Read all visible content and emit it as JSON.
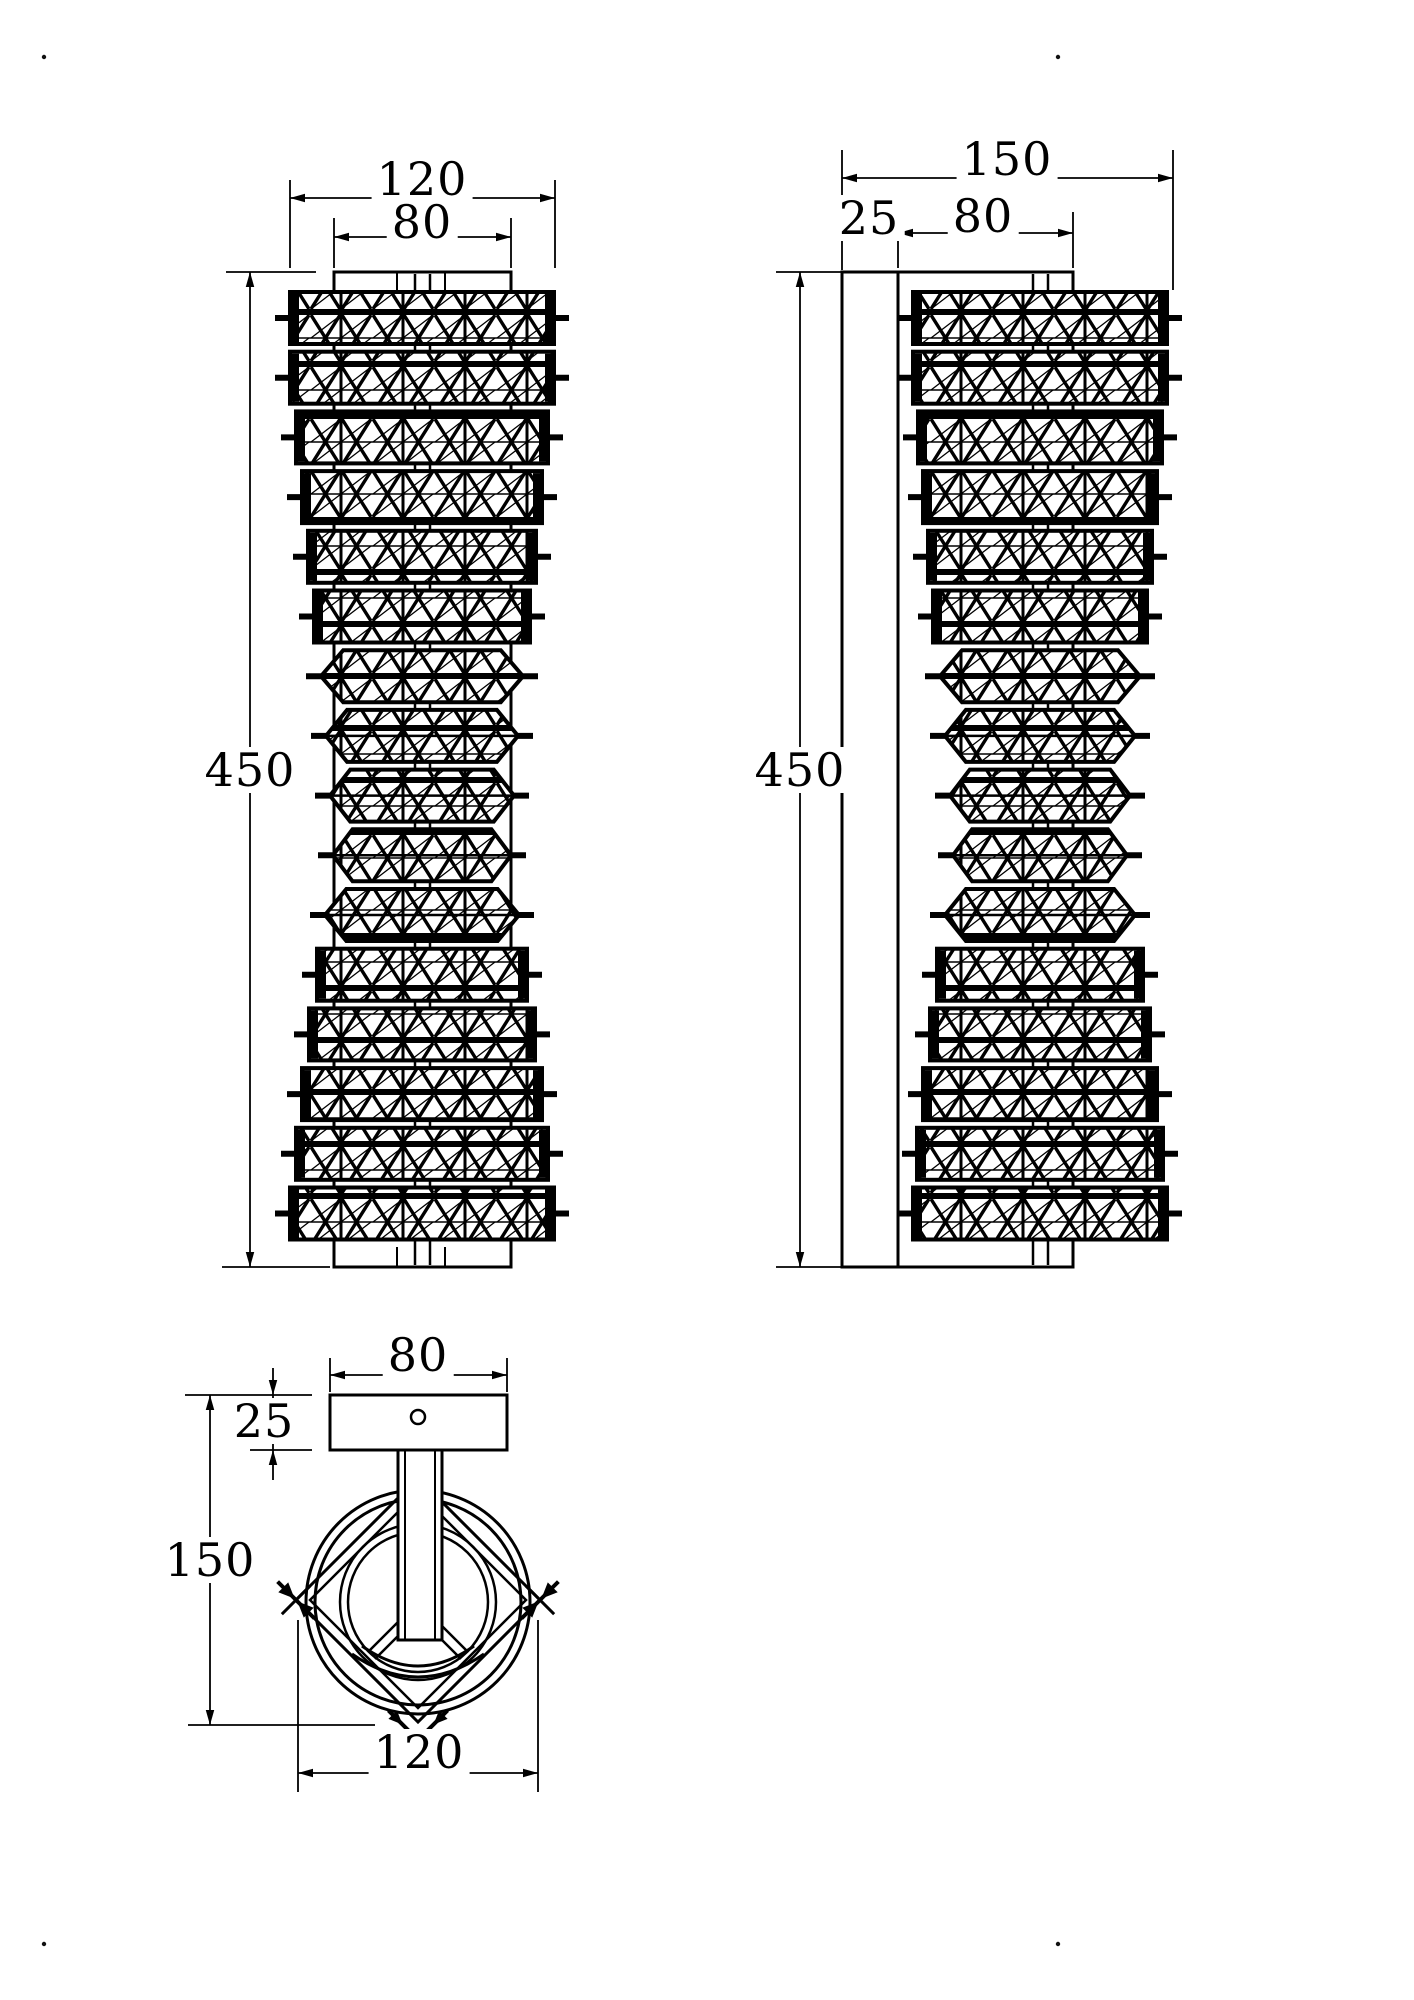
{
  "drawing": {
    "type": "technical-dimension-drawing",
    "subject": "crystal wall lamp – three orthographic views",
    "ink_color": "#000000",
    "paper_color": "#ffffff"
  },
  "views": {
    "front": {
      "dims": {
        "width_outer": "120",
        "width_inner": "80",
        "height": "450"
      }
    },
    "side": {
      "dims": {
        "depth_total": "150",
        "wall_plate": "25",
        "body_depth": "80",
        "height": "450"
      }
    },
    "bottom": {
      "dims": {
        "plate_width": "80",
        "plate_thickness": "25",
        "depth": "150",
        "width": "120"
      }
    }
  }
}
